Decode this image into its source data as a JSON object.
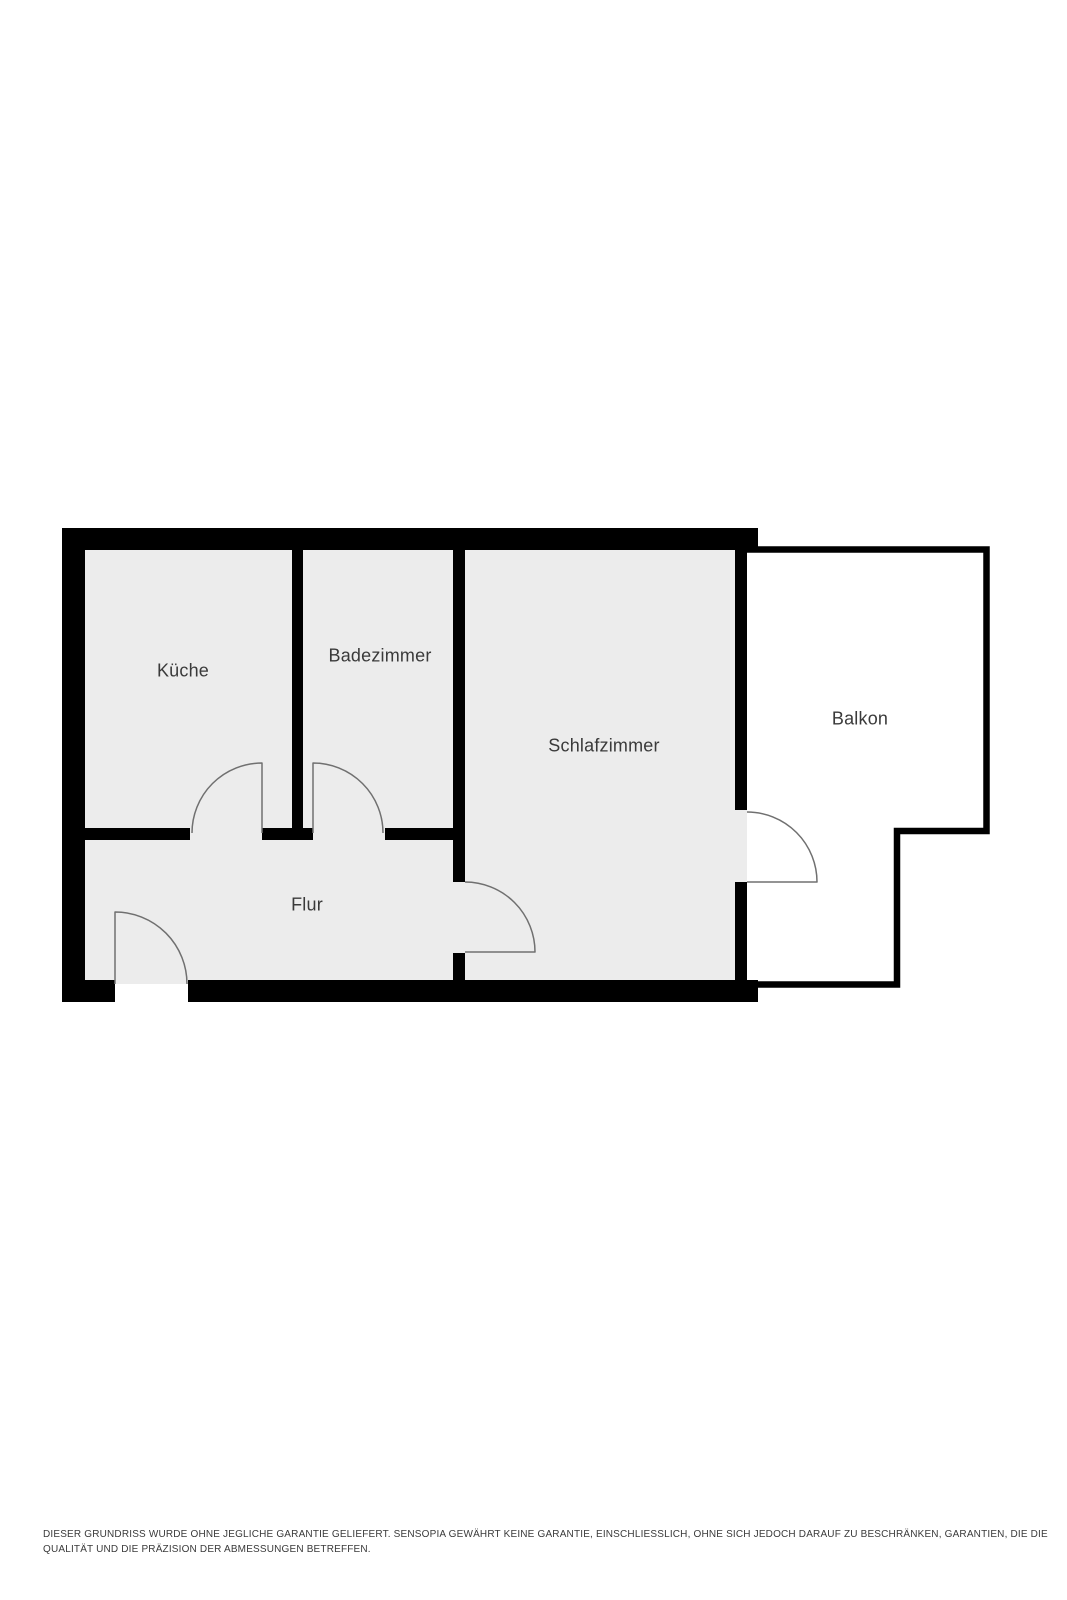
{
  "page": {
    "title": "Grundriss",
    "background": "#ffffff"
  },
  "floorplan": {
    "colors": {
      "wall": "#000000",
      "floor": "#ececec",
      "door_arc": "#707070",
      "interior_door_fill": "#ececec",
      "balcony_door_fill": "#ffffff",
      "label_text": "#3a3a3a"
    },
    "rooms": [
      {
        "id": "kueche",
        "label": "Küche"
      },
      {
        "id": "badezimmer",
        "label": "Badezimmer"
      },
      {
        "id": "schlafzimmer",
        "label": "Schlafzimmer"
      },
      {
        "id": "flur",
        "label": "Flur"
      },
      {
        "id": "balkon",
        "label": "Balkon"
      }
    ]
  },
  "footer": {
    "lines": [
      "DIESER GRUNDRISS WURDE OHNE JEGLICHE GARANTIE GELIEFERT. SENSOPIA GEWÄHRT KEINE GARANTIE, EINSCHLIESSLICH, OHNE SICH JEDOCH DARAUF ZU BESCHRÄNKEN, GARANTIEN, DIE DIE",
      "QUALITÄT UND DIE PRÄZISION DER ABMESSUNGEN BETREFFEN."
    ]
  }
}
